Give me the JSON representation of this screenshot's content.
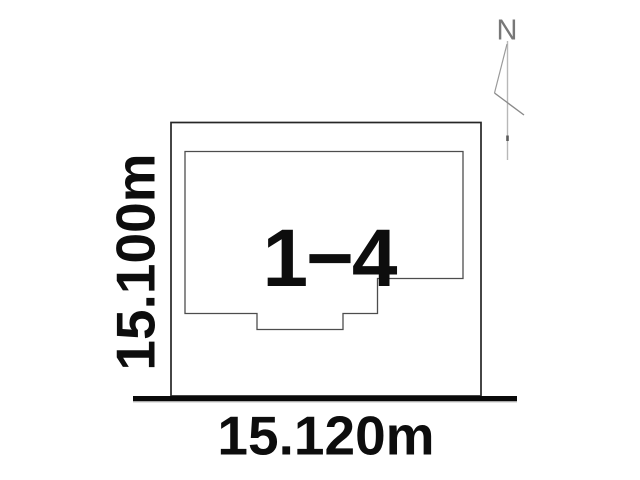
{
  "lot": {
    "label": "1−4"
  },
  "dimensions": {
    "width": "15.120m",
    "height": "15.100m"
  },
  "compass": {
    "north_label": "N"
  },
  "colors": {
    "outer_boundary_line": "#262626",
    "lot_outline_line": "#4d4d4d",
    "road_baseline": "#0a0a0a",
    "label_text": "#0d0d0d",
    "compass_gray": "#8a8a8a"
  }
}
